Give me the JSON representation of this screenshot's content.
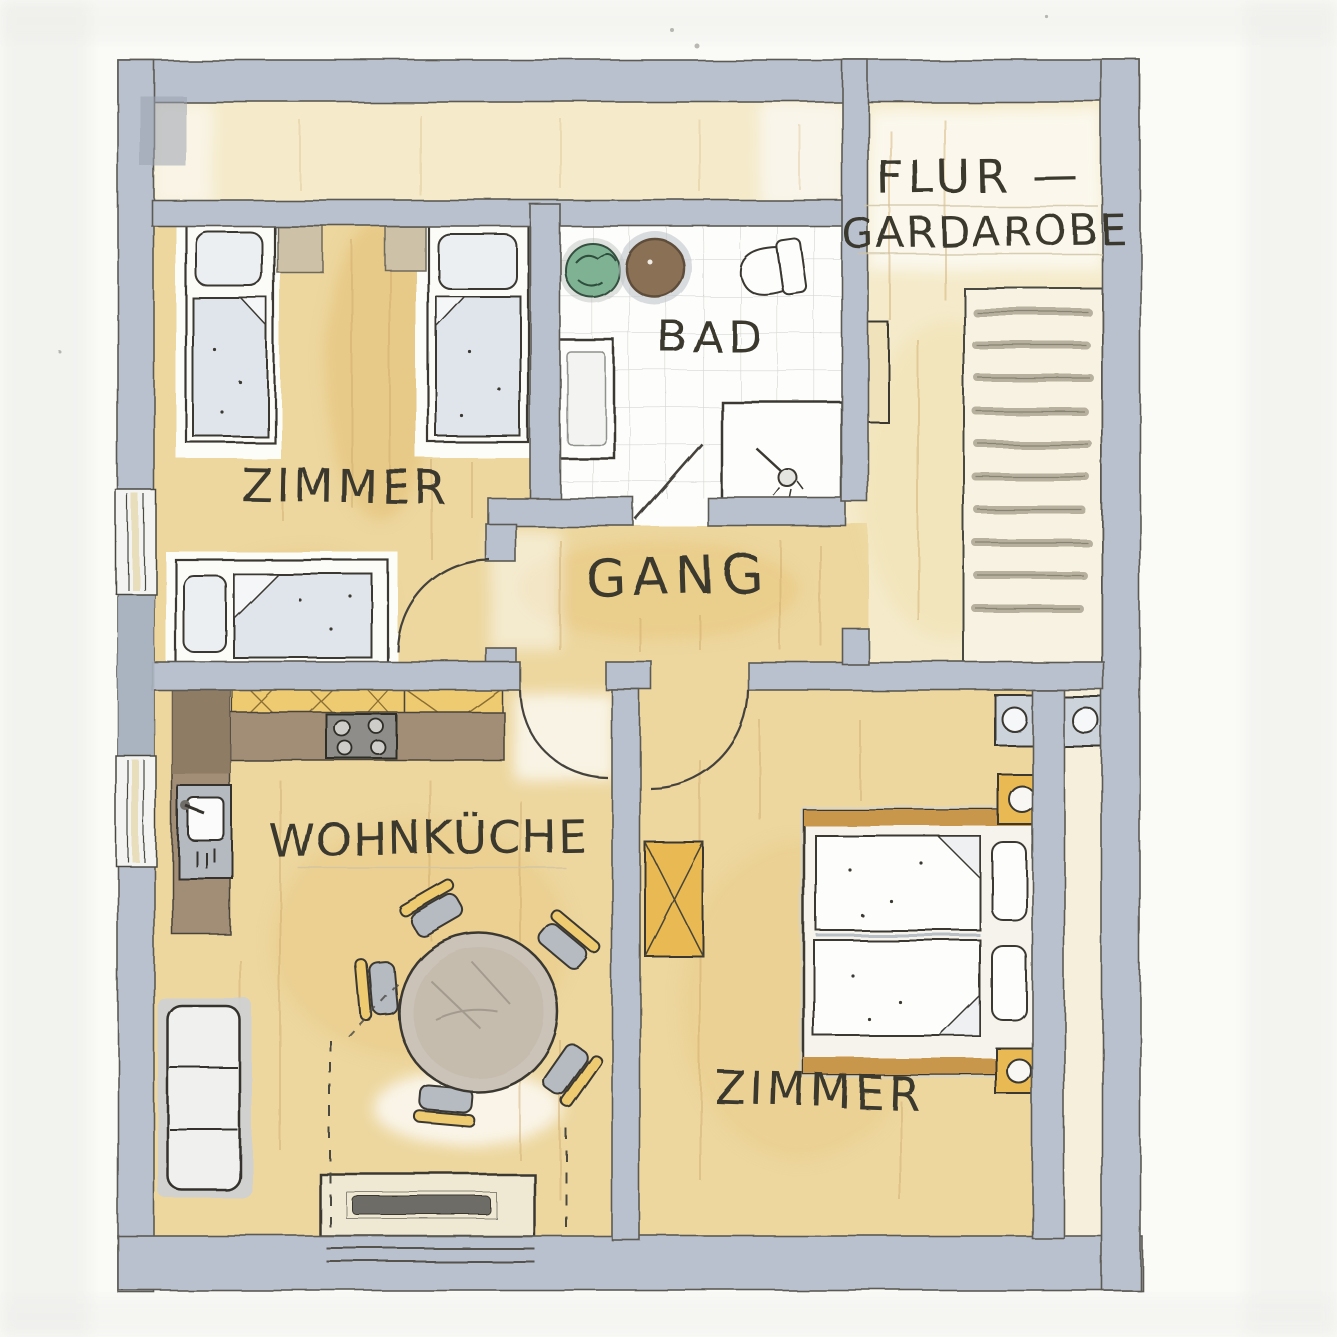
{
  "document": {
    "type": "hand-drawn watercolor floor plan",
    "language": "German"
  },
  "labels": {
    "flur_line1": "FLUR —",
    "flur_line2": "GARDAROBE",
    "bad": "BAD",
    "zimmer_top": "ZIMMER",
    "gang": "GANG",
    "wohnkueche": "WOHNKÜCHE",
    "zimmer_bottom": "ZIMMER"
  },
  "colors": {
    "wall": "#b9c1ce",
    "wall_edge": "#5c5a52",
    "ink": "#3a372f",
    "floor_warm": "#edd79f",
    "floor_pale": "#f5ebcb",
    "tile": "#fdfdfb",
    "counter": "#a28d76",
    "cabinet": "#eecb70",
    "wardrobe": "#e9ba52",
    "blanket": "#dfe5eb",
    "plant": "#7fb293",
    "stove": "#8f8d89",
    "table": "#cbc3b7"
  },
  "rooms": {
    "flur_garderobe": {
      "furniture": [
        "staircase",
        "wardrobe-cabinet"
      ]
    },
    "bad": {
      "furniture": [
        "plant",
        "round-basin",
        "toilet",
        "washbasin",
        "shower"
      ]
    },
    "zimmer_top": {
      "furniture": [
        "single-bed",
        "single-bed",
        "single-bed",
        "nightstand",
        "nightstand"
      ]
    },
    "gang": {
      "furniture": []
    },
    "wohnkueche": {
      "furniture": [
        "kitchen-counter",
        "stove",
        "sink",
        "dining-table",
        "chair",
        "chair",
        "chair",
        "chair",
        "chair",
        "sofa",
        "sideboard"
      ]
    },
    "zimmer_bottom": {
      "furniture": [
        "double-bed",
        "wardrobe",
        "nightstand",
        "nightstand",
        "washbasin",
        "washbasin"
      ]
    }
  }
}
